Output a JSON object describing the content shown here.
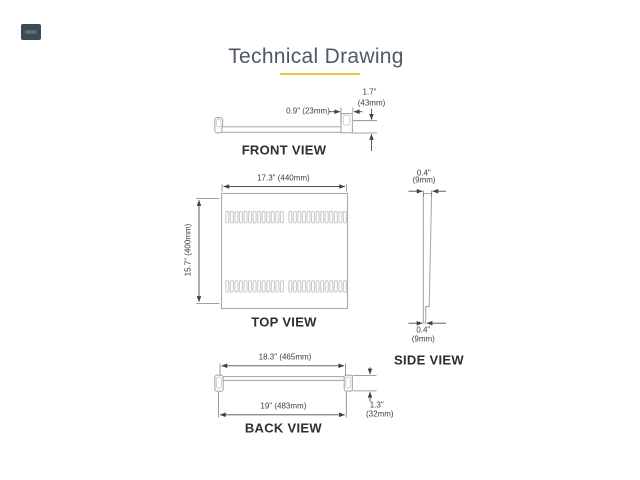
{
  "page": {
    "title": "Technical Drawing"
  },
  "colors": {
    "accent": "#e9c83d",
    "title_text": "#4e5a66",
    "dim_text": "#3b3e40",
    "label_text": "#2c2e30",
    "line": "#a6abaf",
    "dim_line": "#4c4f52"
  },
  "front_view": {
    "label": "FRONT VIEW",
    "dim_lip": "0.9\" (23mm)",
    "dim_height_in": "1.7\"",
    "dim_height_mm": "(43mm)"
  },
  "top_view": {
    "label": "TOP VIEW",
    "dim_width": "17.3\" (440mm)",
    "dim_depth": "15.7\" (400mm)",
    "vents": {
      "rows": 2,
      "groups_per_row": 2,
      "slots_per_group": 13
    }
  },
  "side_view": {
    "label": "SIDE VIEW",
    "dim_top_in": "0.4\"",
    "dim_top_mm": "(9mm)",
    "dim_bottom_in": "0.4\"",
    "dim_bottom_mm": "(9mm)"
  },
  "back_view": {
    "label": "BACK VIEW",
    "dim_inner_width": "18.3\" (465mm)",
    "dim_outer_width": "19\" (483mm)",
    "dim_height_in": "1.3\"",
    "dim_height_mm": "(32mm)"
  }
}
